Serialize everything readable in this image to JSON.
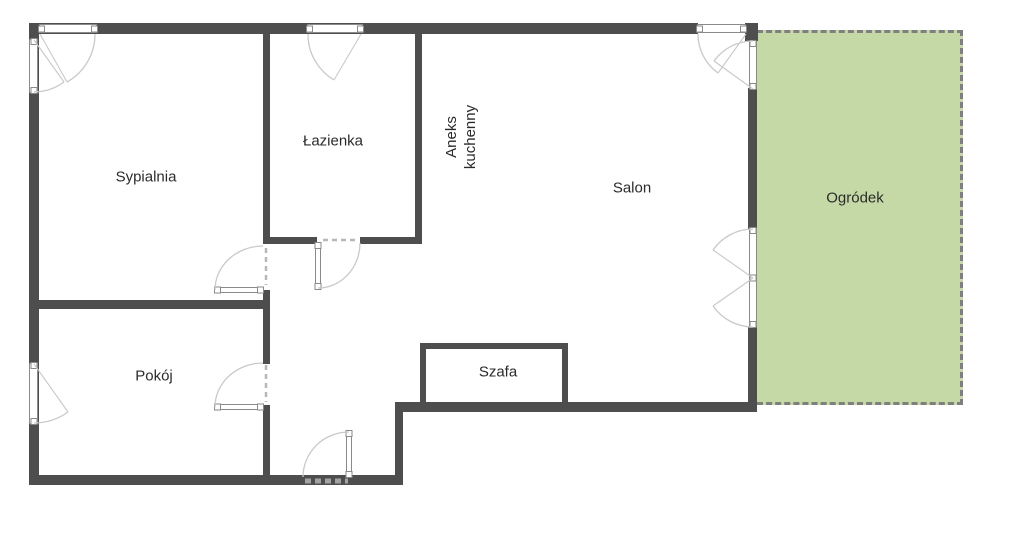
{
  "floorplan": {
    "rooms": {
      "sypialnia": {
        "label": "Sypialnia"
      },
      "lazienka": {
        "label": "Łazienka"
      },
      "aneks": {
        "label_line1": "Aneks",
        "label_line2": "kuchenny"
      },
      "salon": {
        "label": "Salon"
      },
      "pokoj": {
        "label": "Pokój"
      },
      "szafa": {
        "label": "Szafa"
      },
      "ogrodek": {
        "label": "Ogródek"
      }
    },
    "colors": {
      "wall": "#4e4e4e",
      "window_frame": "#8a8a8a",
      "swing_arc": "#c9c9c9",
      "garden_fill": "#c5d9a6",
      "garden_border": "#7f7f7f",
      "label_text": "#2b2b2b",
      "background": "#ffffff"
    }
  }
}
